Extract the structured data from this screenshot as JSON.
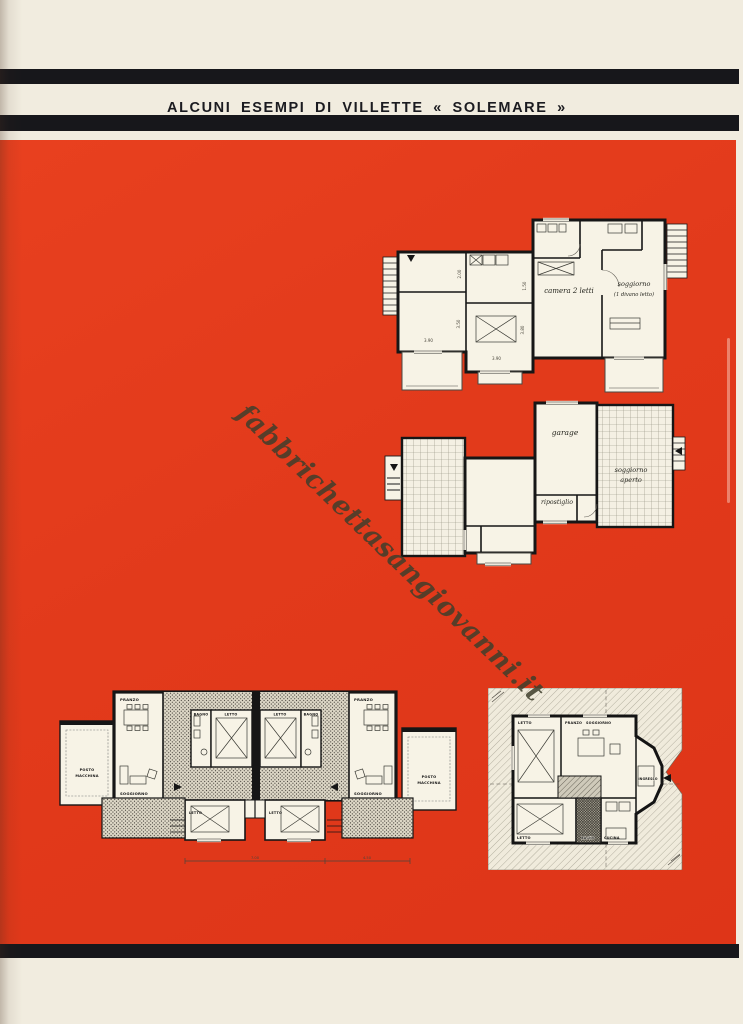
{
  "page": {
    "title": "ALCUNI ESEMPI DI VILLETTE « SOLEMARE »",
    "watermark": "fabbrichettasangiovanni.it"
  },
  "plan_upper": {
    "camera": "camera 2 letti",
    "soggiorno": "soggiorno",
    "soggiorno_sub": "(1 divano letto)",
    "dims": {
      "d1": "2.00",
      "d2": "1.50",
      "d3": "3.50",
      "d4": "3.90",
      "d5": "3.80",
      "d6": "3.90"
    }
  },
  "plan_ground": {
    "garage": "garage",
    "ripostiglio": "ripostiglio",
    "soggiorno_line1": "soggiorno",
    "soggiorno_line2": "aperto"
  },
  "plan_duplex": {
    "pranzo_left": "PRANZO",
    "soggiorno_left": "SOGGIORNO",
    "posto_left_line1": "POSTO",
    "posto_left_line2": "MACCHINA",
    "bagno_left": "BAGNO",
    "letto_left": "LETTO",
    "letto_right": "LETTO",
    "bagno_right": "BAGNO",
    "pranzo_right": "PRANZO",
    "soggiorno_right": "SOGGIORNO",
    "posto_right_line1": "POSTO",
    "posto_right_line2": "MACCHINA",
    "letto_bottom_left": "LETTO",
    "letto_bottom_right": "LETTO",
    "dims": {
      "d1": "7.00",
      "d2": "4.50"
    }
  },
  "plan_square": {
    "letto_top": "LETTO",
    "pranzo": "PRANZO",
    "soggiorno": "SOGGIORNO",
    "ingresso": "INGRESSO",
    "letto_bottom": "LETTO",
    "bagno": "BAGNO",
    "cucina": "CUCINA"
  }
}
